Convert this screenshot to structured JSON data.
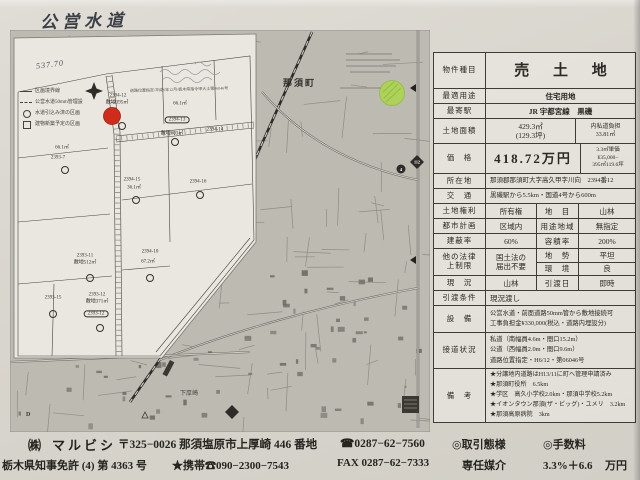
{
  "page": {
    "handwritten_title": "公営水道",
    "handwritten_value": "537.70"
  },
  "cadastral_map": {
    "stamp_line": "道路位置指定/平成6年12月/栃木県指令甲大土第06046号",
    "legend": [
      "区画境界線",
      "公営水道50mm管埋設",
      "水道引込み済の区画",
      "建物新築予定の区画"
    ],
    "marker_color": "#cd2d1a",
    "lot_labels": [
      {
        "x": 108,
        "y": 66,
        "text": "2394-12"
      },
      {
        "x": 107,
        "y": 73,
        "text": "敷地395㎡"
      },
      {
        "x": 112,
        "y": 96,
        "text": "",
        "circle": true
      },
      {
        "x": 170,
        "y": 74,
        "text": "66.1㎡"
      },
      {
        "x": 167,
        "y": 90,
        "text": "2394-13",
        "oval": true
      },
      {
        "x": 162,
        "y": 104,
        "text": "敷地603㎡"
      },
      {
        "x": 165,
        "y": 112,
        "text": "",
        "circle": true
      },
      {
        "x": 205,
        "y": 100,
        "text": "2394-14"
      },
      {
        "x": 52,
        "y": 118,
        "text": "66.1㎡"
      },
      {
        "x": 48,
        "y": 128,
        "text": "2393-7"
      },
      {
        "x": 55,
        "y": 140,
        "text": "",
        "circle": true
      },
      {
        "x": 122,
        "y": 150,
        "text": "2394-15"
      },
      {
        "x": 124,
        "y": 158,
        "text": "36.1㎡"
      },
      {
        "x": 126,
        "y": 170,
        "text": "",
        "circle": true
      },
      {
        "x": 188,
        "y": 152,
        "text": "2394-16"
      },
      {
        "x": 190,
        "y": 165,
        "text": "",
        "circle": true
      },
      {
        "x": 140,
        "y": 222,
        "text": "2394-10"
      },
      {
        "x": 138,
        "y": 232,
        "text": "67.2㎡"
      },
      {
        "x": 140,
        "y": 248,
        "text": "",
        "circle": true
      },
      {
        "x": 75,
        "y": 226,
        "text": "2393-11"
      },
      {
        "x": 75,
        "y": 233,
        "text": "敷地512㎡"
      },
      {
        "x": 80,
        "y": 248,
        "text": "",
        "circle": true
      },
      {
        "x": 43,
        "y": 268,
        "text": "2393-15"
      },
      {
        "x": 43,
        "y": 284,
        "text": "",
        "circle": true
      },
      {
        "x": 87,
        "y": 265,
        "text": "2393-12"
      },
      {
        "x": 87,
        "y": 272,
        "text": "敷地371㎡"
      },
      {
        "x": 86,
        "y": 284,
        "text": "2393-12",
        "oval": true
      },
      {
        "x": 90,
        "y": 298,
        "text": "",
        "circle": true
      }
    ]
  },
  "road_map": {
    "town_label": "那須町",
    "area_label": "下厚崎",
    "grid_letter": "D",
    "route_diamond": "112",
    "route_circle": "4",
    "marker_color": "#a8d83c"
  },
  "property_table": {
    "property_type_label": "物件種目",
    "property_type": "売 土 地",
    "usage_label": "最適用途",
    "usage": "住宅用地",
    "station_label": "最寄駅",
    "station": "JR 宇都宮線　黒磯",
    "area_label": "土地面積",
    "area_main": "429.3㎡",
    "area_tsubo": "(129.3坪)",
    "area_right_label": "内私道負担",
    "area_right_value": "33.81㎡",
    "price_label": "価　格",
    "price_value": "418.72万円",
    "unit_price_lines": [
      "3.3㎡単価",
      "¥35,000−",
      "395㎡119.6坪"
    ],
    "location_label": "所在地",
    "location": "那須郡那須町大字高久甲字川向　2394番12",
    "access_label": "交　通",
    "access": "黒磯駅から5.5km・国道4号から600m",
    "rights_label": "土地権利",
    "rights": "所有権",
    "chimoku_label": "地　目",
    "chimoku": "山林",
    "city_label": "都市計画",
    "city": "区域内",
    "youto_label": "用途地域",
    "youto": "無指定",
    "kenpei_label": "建蔽率",
    "kenpei": "60%",
    "yoseki_label": "容積率",
    "yoseki": "200%",
    "law_label_lines": [
      "他の法律",
      "上制限"
    ],
    "law_value_lines": [
      "国土法の",
      "届出不要"
    ],
    "chisei_label": "地　勢",
    "chisei": "平坦",
    "kankyo_label": "環　境",
    "kankyo": "良",
    "genkyo_label": "現　況",
    "genkyo": "山林",
    "hikiwatashi_label": "引渡日",
    "hikiwatashi": "即時",
    "joken_label": "引渡条件",
    "joken": "現況渡し",
    "setsubi_label": "設　備",
    "setsubi_lines": [
      "公営水道・前面道路50mm管から敷地接続可",
      "工事負担金¥330,000(税込・道路内埋設分)"
    ],
    "setsudo_label": "接道状況",
    "setsudo_lines": [
      "私道（南幅員4.6m・間口15.2m）",
      "公道（西幅員2.0m・間口9.6m）",
      "道路位置指定・H6/12・第06046号"
    ],
    "biko_label": "備　考",
    "biko_lines": [
      "★分譲地内道路はH13/11に町へ管理申請済み",
      "★那須町役所　6.5km",
      "★学区　高久小学校2.0km・那須中学校5.2km",
      "★イオンタウン那須(ザ・ビッグ)・ユメリ　3.2km",
      "★那須高原病院　3km"
    ]
  },
  "footer": {
    "company_prefix": "㈱",
    "company_name": "マルビシ",
    "address": "〒325−0026 那須塩原市上厚崎 446 番地",
    "tel": "☎0287−62−7560",
    "deal_label": "◎取引態様",
    "fee_label": "◎手数料",
    "license": "栃木県知事免許 (4) 第 4363 号",
    "mobile": "★携帯☎090−2300−7543",
    "fax": "FAX 0287−62−7333",
    "deal_value": "専任媒介",
    "fee_value": "3.3%＋6.6",
    "fee_unit": "万円"
  }
}
